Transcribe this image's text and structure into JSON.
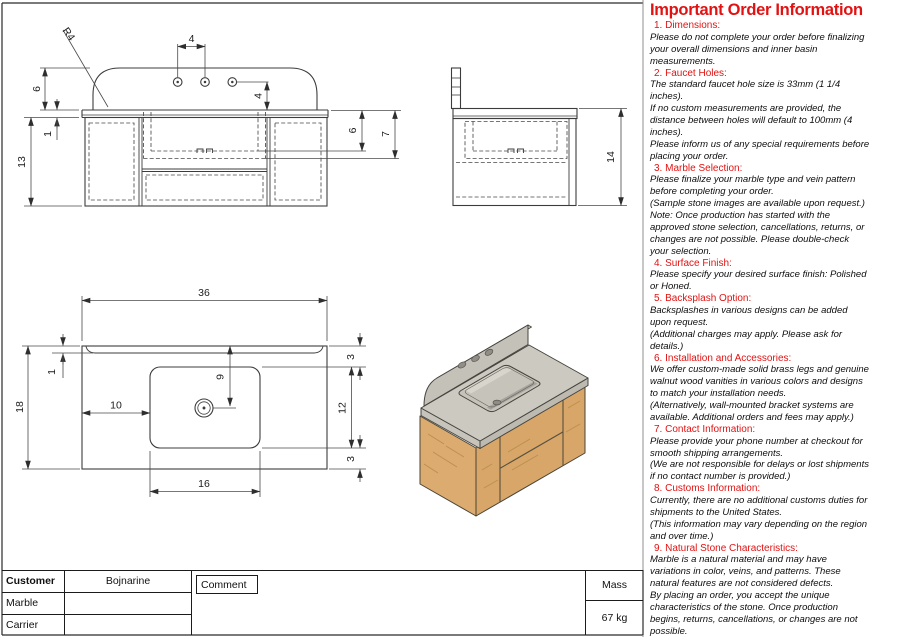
{
  "colors": {
    "accent_red": "#e21212",
    "marble": "#cbc9c0",
    "wood": "#d7a668"
  },
  "drawing": {
    "front_view": {
      "corner_radius": "R4",
      "hole_spacing": "4",
      "hole_to_top": "4",
      "backsplash_height": "6",
      "counter_thickness": "1",
      "cabinet_height": "13",
      "basin_inner_depth": "6",
      "basin_outer_depth": "7"
    },
    "side_view": {
      "overall_height": "14"
    },
    "plan_view": {
      "overall_width": "36",
      "backsplash_thickness": "1",
      "overall_depth": "18",
      "basin_offset_left": "10",
      "drain_offset": "9",
      "basin_depth": "12",
      "back_clearance": "3",
      "front_clearance": "3",
      "basin_width": "16"
    }
  },
  "title_block": {
    "customer_label": "Customer",
    "customer_value": "Bojnarine",
    "comment_label": "Comment",
    "marble_label": "Marble",
    "marble_value": "",
    "carrier_label": "Carrier",
    "carrier_value": "",
    "mass_label": "Mass",
    "mass_value": "67 kg"
  },
  "info_panel": {
    "title": "Important Order Information",
    "sections": [
      {
        "heading": "1. Dimensions:",
        "lines": [
          "Please do not complete your order before finalizing",
          "your overall dimensions and inner basin",
          "measurements."
        ]
      },
      {
        "heading": "2. Faucet Holes:",
        "lines": [
          "The standard faucet hole size is 33mm (1 1/4",
          "inches).",
          "If no custom measurements are provided, the",
          "distance between holes will default to 100mm (4",
          "inches).",
          "Please inform us of any special requirements before",
          "placing your order."
        ]
      },
      {
        "heading": "3. Marble Selection:",
        "lines": [
          "Please finalize your marble type and vein pattern",
          "before completing your order.",
          "(Sample stone images are available upon request.)",
          "Note: Once production has started with the",
          "approved stone selection, cancellations, returns, or",
          "changes are not possible. Please double-check",
          "your selection."
        ]
      },
      {
        "heading": "4. Surface Finish:",
        "lines": [
          "Please specify your desired surface finish: Polished",
          "or Honed."
        ]
      },
      {
        "heading": "5. Backsplash Option:",
        "lines": [
          "Backsplashes in various designs can be added",
          "upon request.",
          "(Additional charges may apply. Please ask for",
          "details.)"
        ]
      },
      {
        "heading": "6. Installation and Accessories:",
        "lines": [
          "We offer custom-made solid brass legs and genuine",
          "walnut wood vanities in various colors and designs",
          "to match your installation needs.",
          "(Alternatively, wall-mounted bracket systems are",
          "available. Additional orders and fees may apply.)"
        ]
      },
      {
        "heading": "7. Contact Information:",
        "lines": [
          "Please provide your phone number at checkout for",
          "smooth shipping arrangements.",
          "(We are not responsible for delays or lost shipments",
          "if no contact number is provided.)"
        ]
      },
      {
        "heading": "8. Customs Information:",
        "lines": [
          "Currently, there are no additional customs duties for",
          "shipments to the United States.",
          "(This information may vary depending on the region",
          "and over time.)"
        ]
      },
      {
        "heading": "9. Natural Stone Characteristics:",
        "lines": [
          "Marble is a natural material and may have",
          "variations in color, veins, and patterns. These",
          "natural features are not considered defects.",
          "By placing an order, you accept the unique",
          "characteristics of the stone. Once production",
          "begins, returns, cancellations, or changes are not",
          "possible."
        ]
      }
    ]
  }
}
